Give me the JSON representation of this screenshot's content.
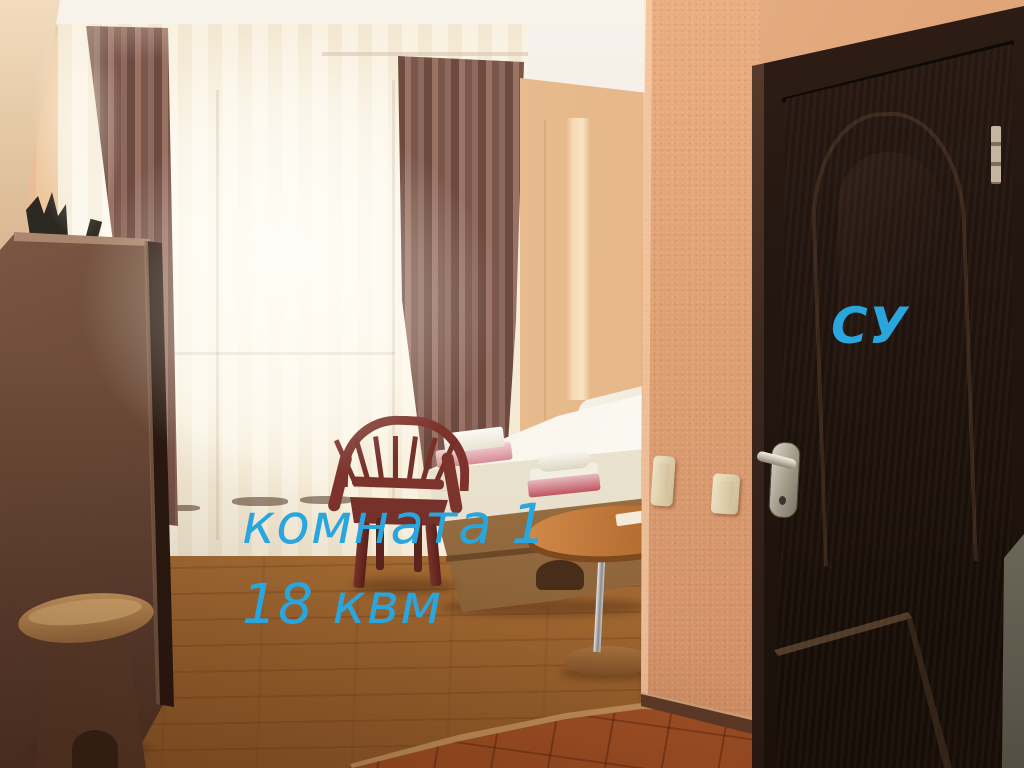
{
  "annotations": {
    "room_label": "комната 1",
    "area_label": "18 квм",
    "door_label": "СУ",
    "annotation_color": "#2aa6de"
  },
  "scene": {
    "setting": "hotel room interior photograph",
    "objects": [
      "ceiling",
      "salmon textured walls",
      "window with sheer curtain",
      "mauve drape curtains",
      "dark wardrobe panel with plant on top",
      "padded stool",
      "maroon plastic armchair",
      "bed with white mattress",
      "towel stacks",
      "floral pillow",
      "dark wood headboard",
      "round pedestal table with paper",
      "cream light switches",
      "dark wenge door with arched panel",
      "chrome lever handle",
      "door hinge",
      "laminate floor",
      "terracotta tile floor with threshold"
    ]
  },
  "palette": {
    "wall_salmon": "#dfa177",
    "door_dark": "#241711",
    "floor_laminate": "#b5793f",
    "floor_tiles": "#b35c2c",
    "curtain_mauve": "#8a6258",
    "ceiling": "#f4efe8",
    "annotation_cyan": "#2aa6de"
  }
}
